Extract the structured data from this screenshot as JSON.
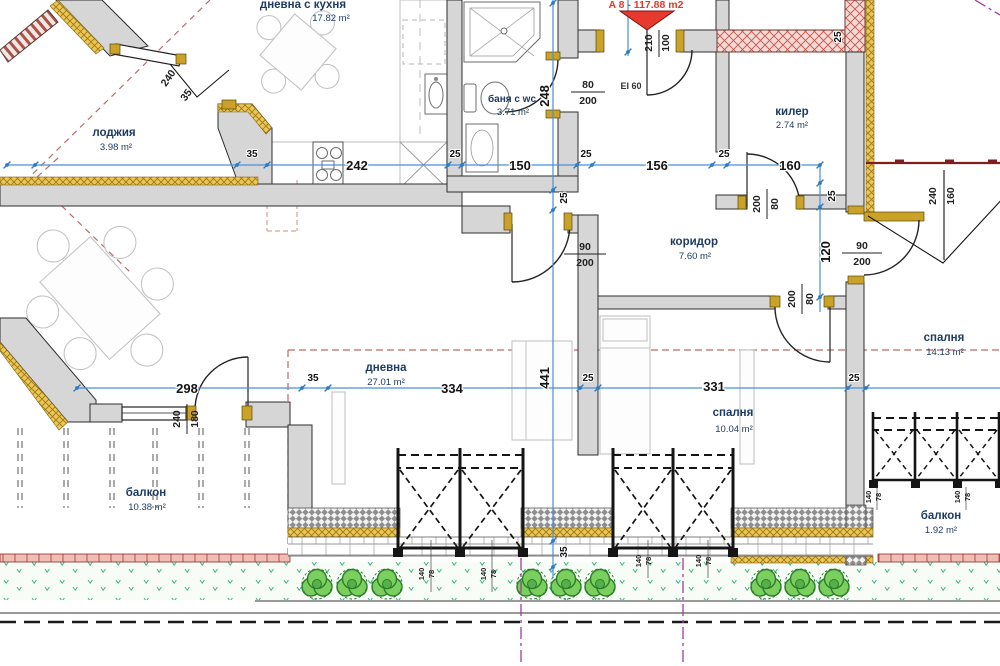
{
  "annotations": {
    "unit": "A 8 - 117.88 m2",
    "fire": "EI 60"
  },
  "rooms": [
    {
      "name": "дневна с кухня",
      "area": "17.82 m²"
    },
    {
      "name": "лоджия",
      "area": "3.98 m²"
    },
    {
      "name": "баня с wc",
      "area": "3.71 m²"
    },
    {
      "name": "килер",
      "area": "2.74 m²"
    },
    {
      "name": "коридор",
      "area": "7.60 m²"
    },
    {
      "name": "спалня",
      "area": "14.13 m²"
    },
    {
      "name": "дневна",
      "area": "27.01 m²"
    },
    {
      "name": "спалня",
      "area": "10.04 m²"
    },
    {
      "name": "балкон",
      "area": "10.38 m²"
    },
    {
      "name": "балкон",
      "area": "1.92 m²"
    }
  ],
  "dims": {
    "a": [
      "35",
      "242",
      "25",
      "150",
      "25",
      "156",
      "25",
      "160"
    ],
    "b": [
      "298",
      "35",
      "334",
      "25",
      "331",
      "25"
    ],
    "v_left": [
      "248",
      "25",
      "441",
      "35"
    ],
    "v_right": [
      "25",
      "120"
    ],
    "wall": "25",
    "entry": {
      "w": "100",
      "h": "210"
    },
    "doors": {
      "bath": {
        "w": "80",
        "h": "200"
      },
      "storage": {
        "w": "80",
        "h": "200"
      },
      "living": {
        "w": "90",
        "h": "200"
      },
      "bedroom_small": {
        "w": "80",
        "h": "200"
      },
      "bedroom_big": {
        "w": "90",
        "h": "200"
      }
    },
    "windows": {
      "bedroom_big": {
        "a": "240",
        "b": "160"
      },
      "loggia": {
        "a": "240",
        "b": "35"
      },
      "balcony": {
        "a": "240",
        "b": "180"
      },
      "sill": {
        "a": "140",
        "b": "78"
      }
    }
  }
}
